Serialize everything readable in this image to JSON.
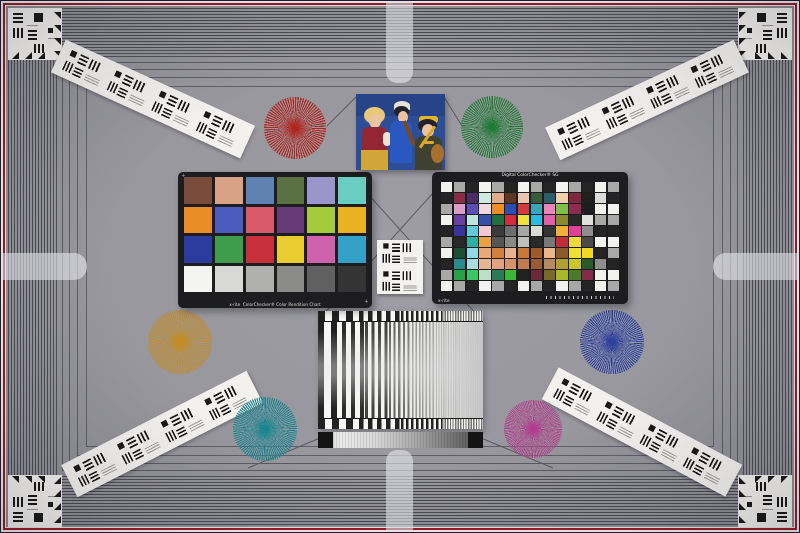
{
  "scene": {
    "name": "camera-test-chart-scene",
    "background": "#97979d"
  },
  "colors": {
    "frame_line": "#4a4a54",
    "frame_outer_dark": "#1c1c34",
    "frame_white": "#f0f0f2",
    "frame_red": "#9a1a22",
    "guide_line": "#5a5a60",
    "cross_arm": "#eaeaf0",
    "card_white": "#f2f1ee",
    "pattern_black": "#171717"
  },
  "frame": {
    "lines": [
      {
        "i": 0,
        "w": 1,
        "c": "#1c1c34"
      },
      {
        "i": 1,
        "w": 2,
        "c": "#f0f0f2"
      },
      {
        "i": 3,
        "w": 2,
        "c": "#9a1a22"
      },
      {
        "i": 5,
        "w": 1,
        "c": "#e8e8ea"
      },
      {
        "i": 8,
        "w": 1,
        "c": "#4a4a54"
      },
      {
        "i": 11,
        "w": 1,
        "c": "#4a4a54"
      },
      {
        "i": 14,
        "w": 1,
        "c": "#4a4a54"
      },
      {
        "i": 17,
        "w": 1,
        "c": "#4a4a54"
      },
      {
        "i": 20,
        "w": 1,
        "c": "#4a4a54"
      },
      {
        "i": 23,
        "w": 1,
        "c": "#4a4a54"
      },
      {
        "i": 26,
        "w": 1,
        "c": "#4a4a54"
      },
      {
        "i": 29,
        "w": 1,
        "c": "#4a4a54"
      },
      {
        "i": 32,
        "w": 1,
        "c": "#4a4a54"
      },
      {
        "i": 35,
        "w": 1,
        "c": "#4a4a54"
      },
      {
        "i": 38,
        "w": 1,
        "c": "#4a4a54"
      },
      {
        "i": 41,
        "w": 1,
        "c": "#4a4a54"
      },
      {
        "i": 44,
        "w": 1,
        "c": "#4a4a54"
      },
      {
        "i": 47,
        "w": 1,
        "c": "#4a4a54"
      },
      {
        "i": 50,
        "w": 1,
        "c": "#50505a"
      },
      {
        "i": 53,
        "w": 1,
        "c": "#50505a"
      },
      {
        "i": 56,
        "w": 1,
        "c": "#50505a"
      },
      {
        "i": 62,
        "w": 1,
        "c": "#5a5a63"
      },
      {
        "i": 69,
        "w": 1,
        "c": "#5a5a63"
      },
      {
        "i": 77,
        "w": 1,
        "c": "#5e5e66"
      },
      {
        "i": 86,
        "w": 1,
        "c": "#60606a"
      }
    ]
  },
  "guides": [
    {
      "x1": 348,
      "y1": 172,
      "x2": 478,
      "y2": 316
    },
    {
      "x1": 452,
      "y1": 172,
      "x2": 322,
      "y2": 316
    },
    {
      "x1": 320,
      "y1": 438,
      "x2": 248,
      "y2": 468
    },
    {
      "x1": 481,
      "y1": 438,
      "x2": 553,
      "y2": 468
    },
    {
      "x1": 356,
      "y1": 97,
      "x2": 327,
      "y2": 126
    },
    {
      "x1": 444,
      "y1": 97,
      "x2": 462,
      "y2": 126
    }
  ],
  "stars": [
    {
      "name": "red",
      "color": "#b1241c",
      "x": 295,
      "y": 128,
      "d": 62,
      "p": 2.5
    },
    {
      "name": "green",
      "color": "#1f7a33",
      "x": 492,
      "y": 127,
      "d": 62,
      "p": 2.3
    },
    {
      "name": "orange",
      "color": "#c68b20",
      "x": 180,
      "y": 342,
      "d": 64,
      "p": 2.1
    },
    {
      "name": "blue",
      "color": "#2c3f9f",
      "x": 612,
      "y": 342,
      "d": 64,
      "p": 2.1
    },
    {
      "name": "teal",
      "color": "#178590",
      "x": 265,
      "y": 429,
      "d": 64,
      "p": 2.1
    },
    {
      "name": "magenta",
      "color": "#b23a8e",
      "x": 533,
      "y": 429,
      "d": 58,
      "p": 1.8
    }
  ],
  "strips": [
    {
      "name": "top-left",
      "x": 153,
      "y": 99,
      "rot": 24.5
    },
    {
      "name": "top-right",
      "x": 647,
      "y": 100,
      "rot": -25
    },
    {
      "name": "bottom-left",
      "x": 162,
      "y": 434,
      "rot": -27
    },
    {
      "name": "bottom-right",
      "x": 642,
      "y": 432,
      "rot": 28
    }
  ],
  "colorchecker_classic": {
    "brand": "x-rite",
    "caption": "ColorChecker® Color Rendition Chart",
    "plus_mark": "+",
    "patches": [
      "#7a4b3a",
      "#d9a186",
      "#5f82b2",
      "#5a7243",
      "#9b95c9",
      "#69cdc2",
      "#e78c27",
      "#4a5cbe",
      "#d85a6a",
      "#693a78",
      "#a3cb3c",
      "#e9b222",
      "#2c3c9e",
      "#3f9c4c",
      "#c8303c",
      "#e8cc30",
      "#cf62ac",
      "#35a0c8",
      "#f4f4f1",
      "#d8d8d5",
      "#b0b0ad",
      "#8a8a87",
      "#606060",
      "#343434"
    ]
  },
  "colorchecker_sg": {
    "title": "Digital ColorChecker® SG",
    "brand": "x-rite",
    "rows": 10,
    "cols": 14,
    "patches": [
      "#f2f2ef",
      "#a8a8a6",
      "#242424",
      "#f2f2ef",
      "#a8a8a6",
      "#242424",
      "#f2f2ef",
      "#a8a8a6",
      "#242424",
      "#f2f2ef",
      "#a8a8a6",
      "#242424",
      "#f2f2ef",
      "#a8a8a6",
      "#242424",
      "#8a2c44",
      "#4a2d66",
      "#cde9e2",
      "#dfae8a",
      "#5e3622",
      "#ebc4ae",
      "#3a5a3c",
      "#2a5e68",
      "#f4cfaa",
      "#7e2840",
      "#202020",
      "#dcdcda",
      "#242424",
      "#a8a8a6",
      "#d79fc6",
      "#5b4eb4",
      "#f2d9e0",
      "#ed8e2b",
      "#2b4fb0",
      "#d23a40",
      "#3aa4b8",
      "#ec86ba",
      "#7fbe4a",
      "#8c2c52",
      "#1e1e1e",
      "#f2f2ef",
      "#f2f2ef",
      "#f2f2ef",
      "#6a3fa2",
      "#bfe4de",
      "#3450a8",
      "#227040",
      "#d22c3c",
      "#f0e13c",
      "#2cb9e2",
      "#e160a8",
      "#8a8a2e",
      "#282828",
      "#e0e0dd",
      "#a8a8a6",
      "#a8a8a6",
      "#242424",
      "#35359a",
      "#66c8d8",
      "#f2c8d2",
      "#3a3a3a",
      "#6e6e6e",
      "#a6a6a3",
      "#dadad7",
      "#333333",
      "#f0b03a",
      "#e24098",
      "#8e8e8b",
      "#242424",
      "#242424",
      "#a8a8a6",
      "#282828",
      "#2fb0a2",
      "#e8a23e",
      "#565656",
      "#8a8a87",
      "#bebebb",
      "#2a2a2a",
      "#787878",
      "#c22c38",
      "#f2d83a",
      "#4a4a4a",
      "#f2f2ef",
      "#f2f2ef",
      "#f2f2ef",
      "#1e4e38",
      "#92d8e8",
      "#e8a878",
      "#d2803e",
      "#eab390",
      "#c87838",
      "#a05a2c",
      "#e8b888",
      "#8a5a2c",
      "#f2e030",
      "#f2d820",
      "#242424",
      "#a8a8a6",
      "#242424",
      "#2a8a8a",
      "#a8dce0",
      "#e9b694",
      "#e2a47e",
      "#d79268",
      "#c27b50",
      "#9a5a34",
      "#b98a60",
      "#b0a030",
      "#c8c82c",
      "#2a5a2a",
      "#8e8e8b",
      "#242424",
      "#a8a8a6",
      "#2aa04a",
      "#3ac864",
      "#bfe0c8",
      "#2a7a5a",
      "#3ab83a",
      "#222222",
      "#6a2a3a",
      "#7a6a2a",
      "#a8b82a",
      "#4a7a2a",
      "#842a4a",
      "#f2f2ef",
      "#f2f2ef",
      "#f2f2ef",
      "#a8a8a6",
      "#242424",
      "#f2f2ef",
      "#a8a8a6",
      "#242424",
      "#f2f2ef",
      "#a8a8a6",
      "#242424",
      "#f2f2ef",
      "#a8a8a6",
      "#242424",
      "#f2f2ef",
      "#a8a8a6"
    ]
  },
  "photo": {
    "subject": "three-costumed-musicians",
    "colors": {
      "bg": "#2c4e96",
      "bg_dark": "#1f3a78",
      "blonde_hair": "#e9c979",
      "skin": "#ecc3a0",
      "red_vest": "#942633",
      "gold_skirt": "#d2a539",
      "white_cloth": "#e8e4da",
      "dark_hair": "#22222e",
      "blue_dress": "#2b58c0",
      "violin_wood": "#7c4a22",
      "headband_gold": "#e2b52a",
      "olive_dress": "#3f4030",
      "lute_wood": "#a8702e",
      "necklace_gold": "#d8a82a"
    }
  },
  "sweep": {
    "ticks": [
      {
        "p": 14,
        "b": 7
      },
      {
        "p": 9,
        "b": 4.5
      },
      {
        "p": 5,
        "b": 2.5
      },
      {
        "p": 2.6,
        "b": 1.3
      }
    ],
    "segments": [
      {
        "p": 13,
        "o": 1
      },
      {
        "p": 9,
        "o": 0.95
      },
      {
        "p": 6.5,
        "o": 0.85
      },
      {
        "p": 4.6,
        "o": 0.7
      },
      {
        "p": 3.4,
        "o": 0.55
      },
      {
        "p": 2.4,
        "o": 0.4
      },
      {
        "p": 1.8,
        "o": 0.28
      }
    ],
    "bar_color": "#222222",
    "gap_color": "#f6f6f4"
  }
}
